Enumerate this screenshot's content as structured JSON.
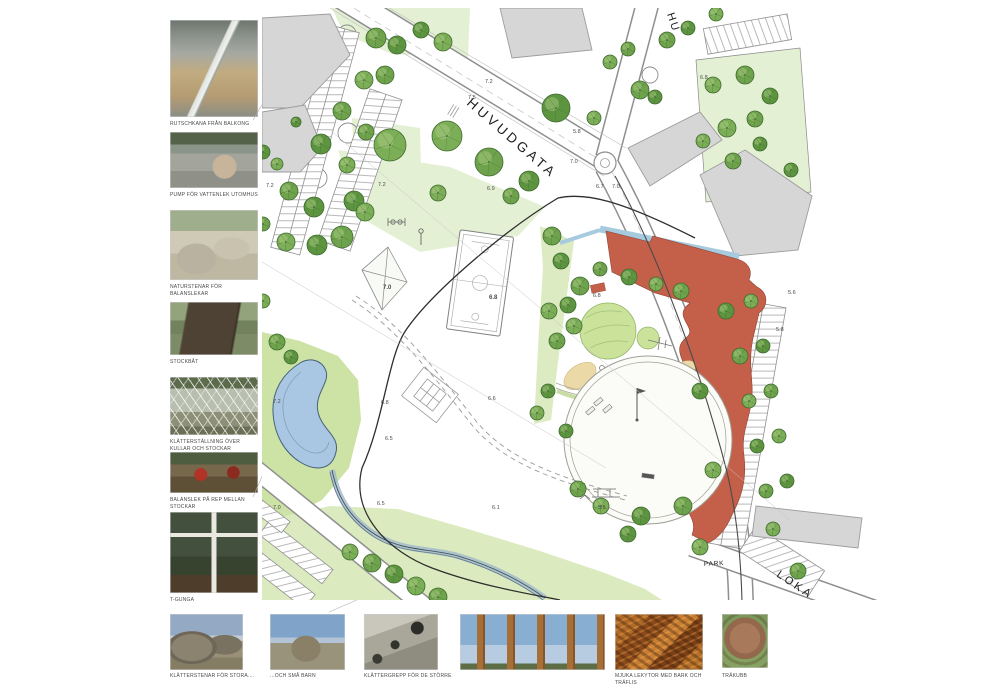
{
  "page": {
    "background": "#ffffff"
  },
  "sidebar": {
    "photos": [
      {
        "id": "slide-from-balcony",
        "caption": "RUTSCHKANA FRÅN BALKONG"
      },
      {
        "id": "water-pump",
        "caption": "PUMP FÖR VATTENLEK UTOMHUS"
      },
      {
        "id": "balance-stones",
        "caption": "NATURSTENAR FÖR BALANSLEKAR"
      },
      {
        "id": "log-boat",
        "caption": "STOCKBÅT"
      },
      {
        "id": "climbing-structure",
        "caption": "KLÄTTERSTÄLLNING ÖVER KULLAR OCH STOCKAR"
      },
      {
        "id": "rope-balance",
        "caption": "BALANSLEK PÅ REP MELLAN STOCKAR"
      },
      {
        "id": "t-swing",
        "caption": "T-GUNGA"
      }
    ]
  },
  "bottom_row": {
    "photos": [
      {
        "id": "climbing-stones-big",
        "caption": "KLÄTTERSTENAR FÖR STORA...."
      },
      {
        "id": "climbing-stones-small",
        "caption": "...OCH SMÅ BARN"
      },
      {
        "id": "climbing-grips",
        "caption": "KLÄTTERGREPP FÖR DE STÖRRE"
      },
      {
        "id": "wooden-poles",
        "caption": ""
      },
      {
        "id": "bark-surface",
        "caption": "MJUKA LEKYTOR MED BARK OCH TRÄFLIS"
      },
      {
        "id": "wood-block-paving",
        "caption": "TRÄKUBB"
      }
    ]
  },
  "plan": {
    "street_labels": [
      {
        "text": "HUVUDGATA",
        "x": 466,
        "y": 104,
        "rotate": 41,
        "size": 13.5,
        "spacing": 3.5
      },
      {
        "text": "HU",
        "x": 667,
        "y": 14,
        "rotate": 72,
        "size": 11,
        "spacing": 2
      },
      {
        "text": "PARK",
        "x": 704,
        "y": 566,
        "rotate": -3,
        "size": 6.5,
        "spacing": 0.8
      },
      {
        "text": "LOKA",
        "x": 776,
        "y": 576,
        "rotate": 34,
        "size": 11,
        "spacing": 3
      }
    ],
    "elevation_labels": [
      {
        "x": 485,
        "y": 83,
        "v": "7.2"
      },
      {
        "x": 468,
        "y": 99,
        "v": "7.5"
      },
      {
        "x": 378,
        "y": 186,
        "v": "7.2"
      },
      {
        "x": 266,
        "y": 187,
        "v": "7.2"
      },
      {
        "x": 487,
        "y": 190,
        "v": "6.9"
      },
      {
        "x": 570,
        "y": 163,
        "v": "7.0"
      },
      {
        "x": 596,
        "y": 188,
        "v": "6.7"
      },
      {
        "x": 612,
        "y": 188,
        "v": "7.0"
      },
      {
        "x": 573,
        "y": 133,
        "v": "5.8"
      },
      {
        "x": 383,
        "y": 289,
        "v": "7.0",
        "b": 1
      },
      {
        "x": 489,
        "y": 299,
        "v": "6.8",
        "b": 1
      },
      {
        "x": 593,
        "y": 297,
        "v": "6.8"
      },
      {
        "x": 700,
        "y": 79,
        "v": "6.8"
      },
      {
        "x": 788,
        "y": 294,
        "v": "5.6"
      },
      {
        "x": 776,
        "y": 331,
        "v": "5.8"
      },
      {
        "x": 273,
        "y": 403,
        "v": "7.2"
      },
      {
        "x": 381,
        "y": 404,
        "v": "6.8"
      },
      {
        "x": 488,
        "y": 400,
        "v": "6.6"
      },
      {
        "x": 385,
        "y": 440,
        "v": "6.5"
      },
      {
        "x": 377,
        "y": 505,
        "v": "6.5"
      },
      {
        "x": 273,
        "y": 509,
        "v": "7.0"
      },
      {
        "x": 492,
        "y": 509,
        "v": "6.1"
      },
      {
        "x": 598,
        "y": 509,
        "v": "5.5"
      }
    ],
    "trees": [
      [
        342,
        111,
        9
      ],
      [
        321,
        144,
        10
      ],
      [
        347,
        165,
        8
      ],
      [
        289,
        191,
        9
      ],
      [
        314,
        207,
        10
      ],
      [
        390,
        145,
        16
      ],
      [
        366,
        132,
        8
      ],
      [
        354,
        201,
        10
      ],
      [
        365,
        212,
        9
      ],
      [
        342,
        237,
        11
      ],
      [
        317,
        245,
        10
      ],
      [
        286,
        242,
        9
      ],
      [
        376,
        38,
        10
      ],
      [
        397,
        45,
        9
      ],
      [
        364,
        80,
        9
      ],
      [
        385,
        75,
        9
      ],
      [
        263,
        152,
        7
      ],
      [
        277,
        164,
        6
      ],
      [
        263,
        224,
        7
      ],
      [
        296,
        122,
        5
      ],
      [
        447,
        136,
        15
      ],
      [
        489,
        162,
        14
      ],
      [
        529,
        181,
        10
      ],
      [
        438,
        193,
        8
      ],
      [
        511,
        196,
        8
      ],
      [
        556,
        108,
        14
      ],
      [
        594,
        118,
        7
      ],
      [
        640,
        90,
        9
      ],
      [
        655,
        97,
        7
      ],
      [
        610,
        62,
        7
      ],
      [
        628,
        49,
        7
      ],
      [
        421,
        30,
        8
      ],
      [
        443,
        42,
        9
      ],
      [
        667,
        40,
        8
      ],
      [
        688,
        28,
        7
      ],
      [
        713,
        85,
        8
      ],
      [
        745,
        75,
        9
      ],
      [
        770,
        96,
        8
      ],
      [
        727,
        128,
        9
      ],
      [
        755,
        119,
        8
      ],
      [
        791,
        170,
        7
      ],
      [
        703,
        141,
        7
      ],
      [
        733,
        161,
        8
      ],
      [
        760,
        144,
        7
      ],
      [
        716,
        14,
        7
      ],
      [
        552,
        236,
        9
      ],
      [
        561,
        261,
        8
      ],
      [
        549,
        311,
        8
      ],
      [
        557,
        341,
        8
      ],
      [
        548,
        391,
        7
      ],
      [
        537,
        413,
        7
      ],
      [
        277,
        342,
        8
      ],
      [
        291,
        357,
        7
      ],
      [
        263,
        301,
        7
      ],
      [
        580,
        286,
        9
      ],
      [
        568,
        305,
        8
      ],
      [
        574,
        326,
        8
      ],
      [
        600,
        269,
        7
      ],
      [
        629,
        277,
        8
      ],
      [
        656,
        284,
        7
      ],
      [
        681,
        291,
        8
      ],
      [
        700,
        391,
        8
      ],
      [
        713,
        470,
        8
      ],
      [
        683,
        506,
        9
      ],
      [
        641,
        516,
        9
      ],
      [
        601,
        506,
        8
      ],
      [
        578,
        489,
        8
      ],
      [
        566,
        431,
        7
      ],
      [
        350,
        552,
        8
      ],
      [
        372,
        563,
        9
      ],
      [
        394,
        574,
        9
      ],
      [
        416,
        586,
        9
      ],
      [
        438,
        597,
        9
      ],
      [
        628,
        534,
        8
      ],
      [
        700,
        547,
        8
      ],
      [
        798,
        571,
        8
      ],
      [
        726,
        311,
        8
      ],
      [
        751,
        301,
        7
      ],
      [
        740,
        356,
        8
      ],
      [
        763,
        346,
        7
      ],
      [
        749,
        401,
        7
      ],
      [
        771,
        391,
        7
      ],
      [
        757,
        446,
        7
      ],
      [
        779,
        436,
        7
      ],
      [
        766,
        491,
        7
      ],
      [
        787,
        481,
        7
      ],
      [
        773,
        529,
        7
      ]
    ],
    "colors": {
      "building_red": "#c4604a",
      "water": "#a9c7e2",
      "lawn_light": "#e4f0d4",
      "lawn_mid": "#dcebbf",
      "park_green": "#cde3a6",
      "tree_green": "#6fa24c",
      "building_gray": "#d6d6d6"
    }
  }
}
